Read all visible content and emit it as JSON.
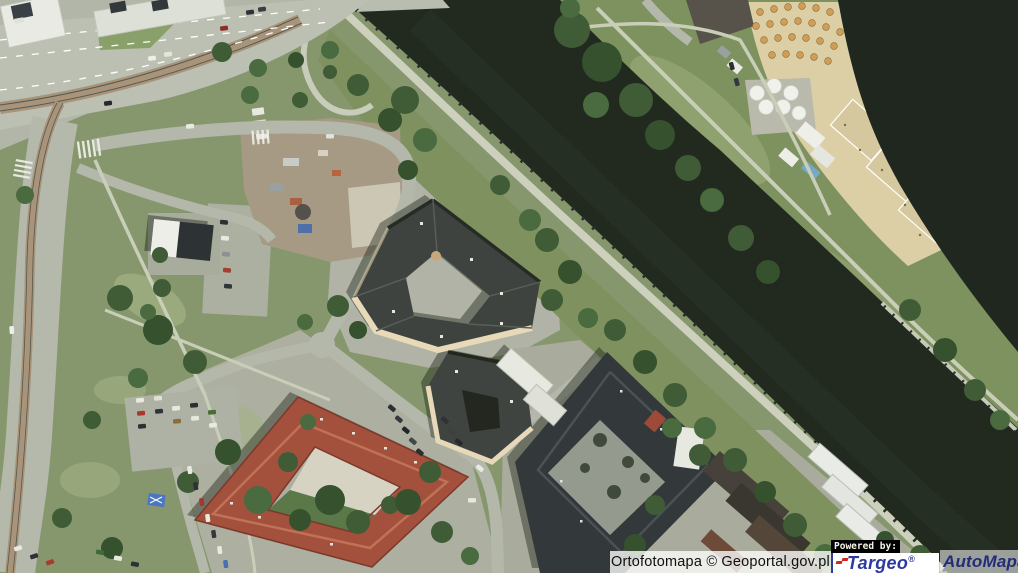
{
  "map": {
    "kind": "aerial-orthophoto",
    "visible_features": [
      "highway-interchange-with-tram-tracks",
      "riverside-park",
      "construction-yard",
      "river-channel-with-embankment-wall",
      "river-basin",
      "city-beach-with-tents-umbrellas-volleyball-courts",
      "triangular-apartment-building",
      "red-roof-courtyard-building",
      "dark-roof-courtyard-building",
      "parking-lots-with-cars",
      "riverside-promenade",
      "tree-clusters"
    ],
    "palette": {
      "water": "#222a20",
      "water_basin": "#1f271f",
      "grass": "#87976d",
      "grass_bank": "#7d925e",
      "road": "#bcc0b3",
      "paving": "#adb0a1",
      "path": "#c9ceb8",
      "sand": "#dccfa5",
      "dirt": "#a69a84",
      "roof_red": "#a3503c",
      "roof_slate": "#3e433f",
      "roof_charcoal": "#33383a",
      "wall_cream": "#e8dab8",
      "building_white": "#e7e9e1"
    }
  },
  "attribution": {
    "text": "Ortofotomapa © Geoportal.gov.pl"
  },
  "branding": {
    "powered_by_label": "Powered by:",
    "underline_color": "#b9bb17",
    "targeo": {
      "name": "Targeo",
      "reg_mark": "®",
      "text_color": "#2d3a9e",
      "dots_color": "#d3281c"
    },
    "automapa": {
      "name": "AutoMapa",
      "reg_mark": "®",
      "text_color": "#222c78"
    }
  }
}
